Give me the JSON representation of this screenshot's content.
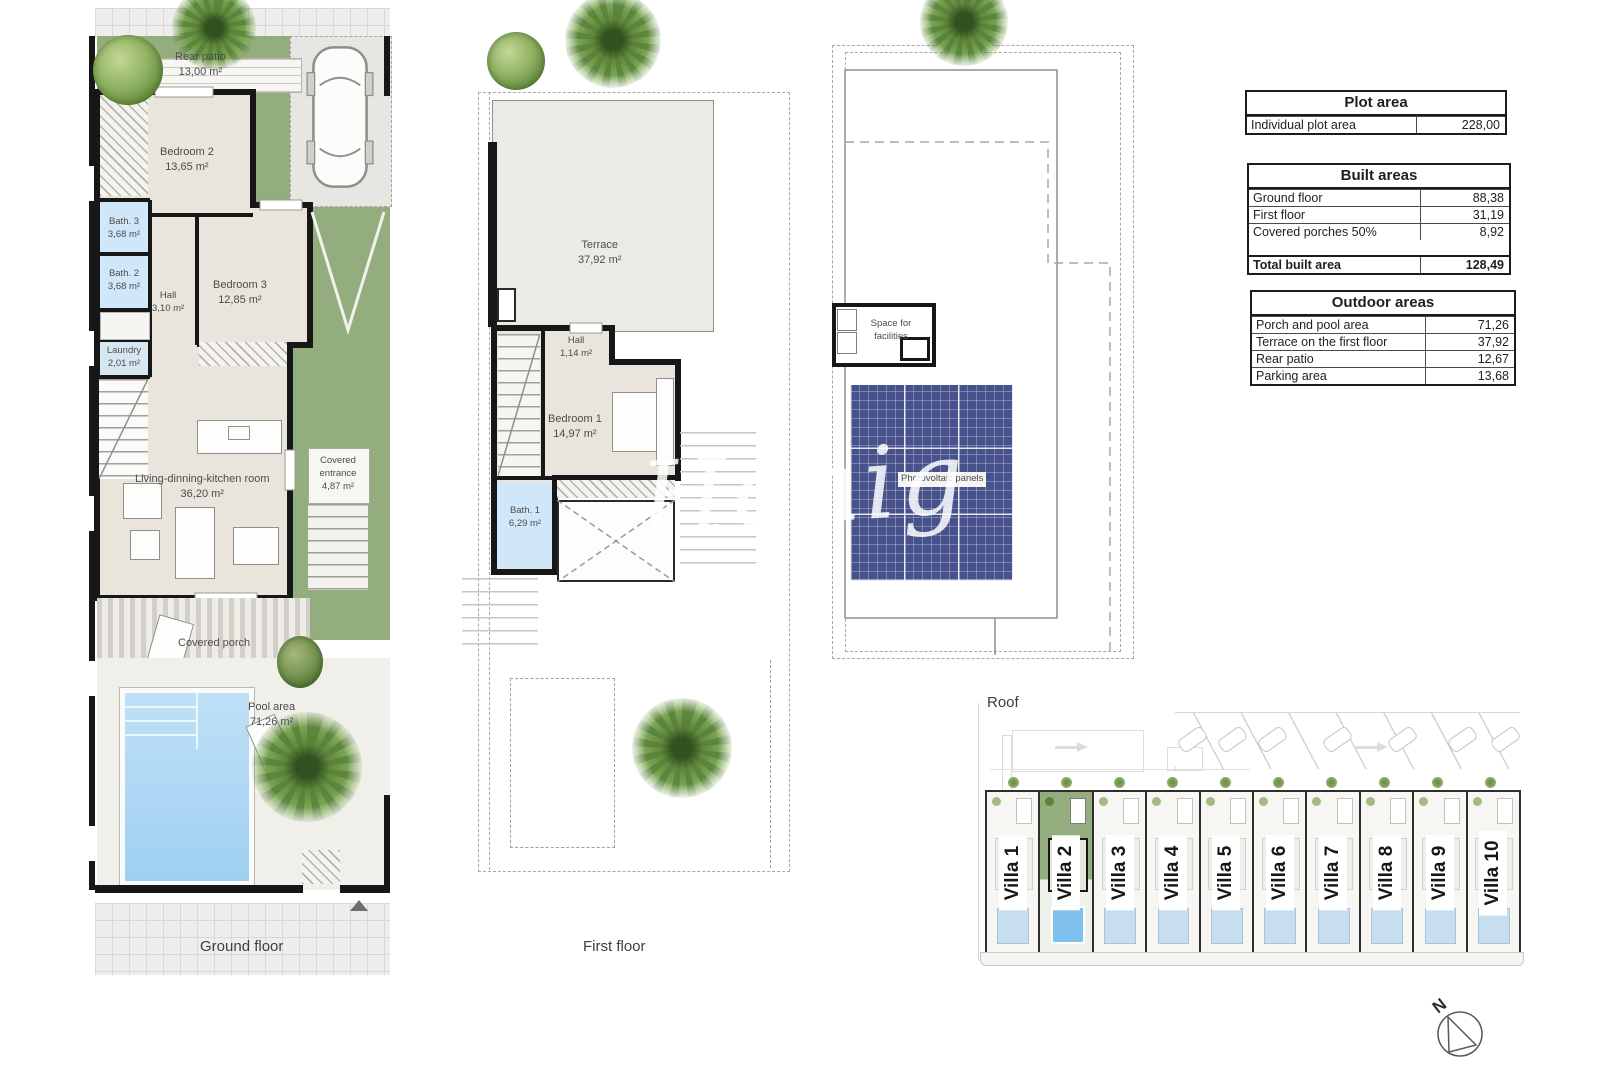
{
  "ground_floor": {
    "title": "Ground floor",
    "rooms": {
      "rear_patio": {
        "name": "Rear patio",
        "area": "13,00 m²"
      },
      "bedroom2": {
        "name": "Bedroom 2",
        "area": "13,65 m²"
      },
      "bath3": {
        "name": "Bath. 3",
        "area": "3,68 m²"
      },
      "bath2": {
        "name": "Bath. 2",
        "area": "3,68 m²"
      },
      "hall": {
        "name": "Hall",
        "area": "3,10 m²"
      },
      "laundry": {
        "name": "Laundry",
        "area": "2,01 m²"
      },
      "bedroom3": {
        "name": "Bedroom 3",
        "area": "12,85 m²"
      },
      "living_kitchen": {
        "name": "Living-dinning-kitchen room",
        "area": "36,20 m²"
      },
      "covered_entrance": {
        "name": "Covered entrance",
        "area": "4,87 m²"
      },
      "covered_porch": {
        "name": "Covered porch"
      },
      "pool": {
        "name": "Pool area",
        "area": "71,26 m²"
      }
    }
  },
  "first_floor": {
    "title": "First floor",
    "rooms": {
      "terrace": {
        "name": "Terrace",
        "area": "37,92 m²"
      },
      "hall": {
        "name": "Hall",
        "area": "1,14 m²"
      },
      "bedroom1": {
        "name": "Bedroom 1",
        "area": "14,97 m²"
      },
      "bath1": {
        "name": "Bath. 1",
        "area": "6,29 m²"
      }
    }
  },
  "roof": {
    "title": "Roof",
    "labels": {
      "facilities": "Space for facilities",
      "photovoltaic": "Photovoltaic panels"
    }
  },
  "tables": {
    "plot": {
      "title": "Plot area",
      "rows": [
        {
          "label": "Individual plot area",
          "value": "228,00"
        }
      ]
    },
    "built": {
      "title": "Built areas",
      "rows": [
        {
          "label": "Ground floor",
          "value": "88,38"
        },
        {
          "label": "First floor",
          "value": "31,19"
        },
        {
          "label": "Covered porches 50%",
          "value": "8,92"
        }
      ],
      "total": {
        "label": "Total built area",
        "value": "128,49"
      }
    },
    "outdoor": {
      "title": "Outdoor areas",
      "rows": [
        {
          "label": "Porch and pool area",
          "value": "71,26"
        },
        {
          "label": "Terrace on the first floor",
          "value": "37,92"
        },
        {
          "label": "Rear patio",
          "value": "12,67"
        },
        {
          "label": "Parking area",
          "value": "13,68"
        }
      ]
    }
  },
  "site_plan": {
    "villas": [
      {
        "label": "Villa 1"
      },
      {
        "label": "Villa 2"
      },
      {
        "label": "Villa 3"
      },
      {
        "label": "Villa 4"
      },
      {
        "label": "Villa 5"
      },
      {
        "label": "Villa 6"
      },
      {
        "label": "Villa 7"
      },
      {
        "label": "Villa 8"
      },
      {
        "label": "Villa 9"
      },
      {
        "label": "Villa 10"
      }
    ]
  },
  "compass": {
    "north": "N"
  },
  "watermark": "Honig"
}
